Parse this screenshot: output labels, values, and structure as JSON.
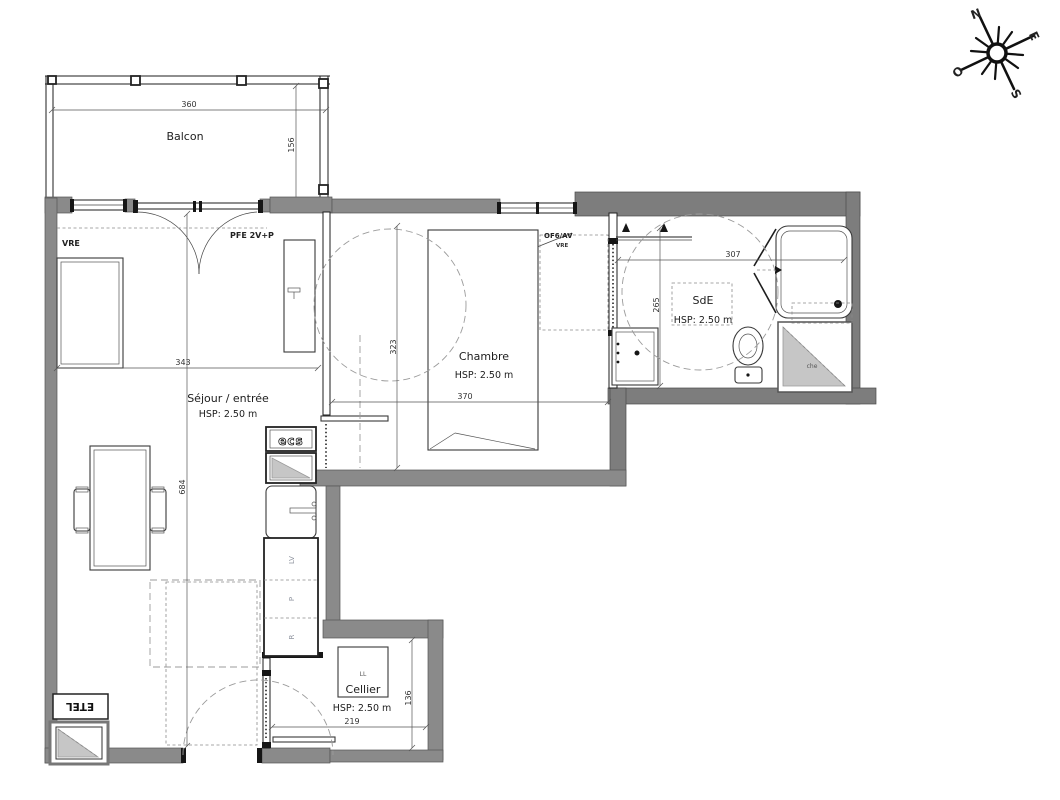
{
  "colors": {
    "wall": "#8a8a8a",
    "furniture_line": "#3a3a3a",
    "dash": "#999999"
  },
  "compass": {
    "n": "N",
    "e": "E",
    "s": "S",
    "w": "O"
  },
  "balcony": {
    "label": "Balcon",
    "width": "360",
    "depth": "156"
  },
  "living": {
    "label": "Séjour / entrée",
    "ceiling": "HSP: 2.50 m",
    "width": "343",
    "depth": "684"
  },
  "bedroom": {
    "label": "Chambre",
    "ceiling": "HSP: 2.50 m",
    "width": "370",
    "depth": "323"
  },
  "bathroom": {
    "label": "SdE",
    "ceiling": "HSP: 2.50 m",
    "width": "307",
    "depth": "265",
    "duct": "che"
  },
  "cellar": {
    "label": "Cellier",
    "ceiling": "HSP: 2.50 m",
    "width": "219",
    "depth": "136"
  },
  "appliances": {
    "water_heater": "ecs",
    "dishwasher": "LV",
    "hob": "P",
    "fridge": "R",
    "washer": "LL"
  },
  "openings": {
    "living_window": "VRE",
    "balcony_door": "PFE 2V+P",
    "bedroom_window": "OF6/AV",
    "bedroom_window_shutter": "VRE"
  },
  "technical": {
    "etel": "ETEL"
  }
}
